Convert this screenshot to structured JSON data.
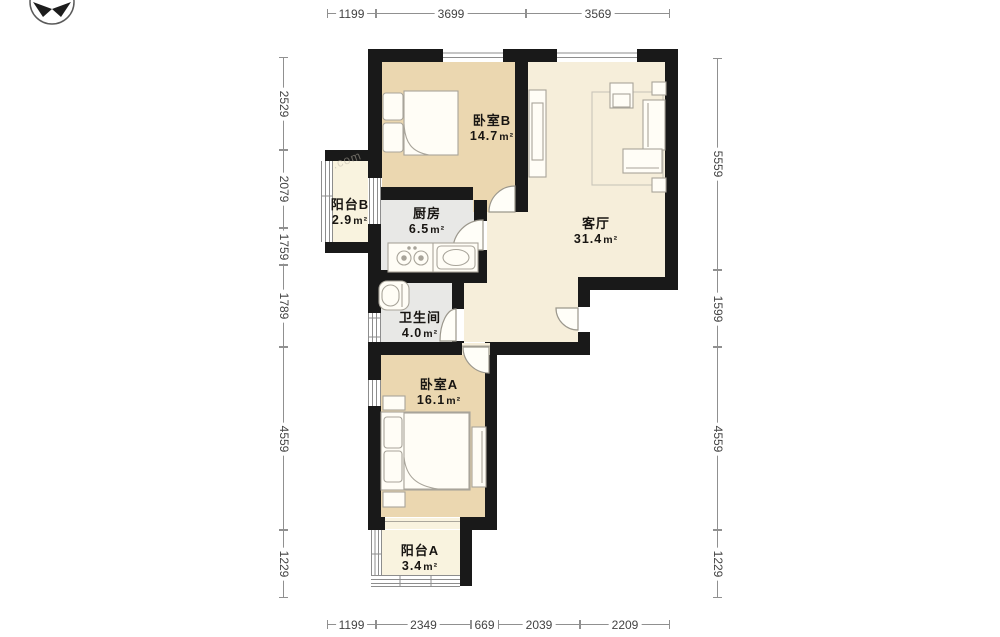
{
  "rooms": [
    {
      "name": "卧室B",
      "area": "14.7",
      "unit": "m²"
    },
    {
      "name": "客厅",
      "area": "31.4",
      "unit": "m²"
    },
    {
      "name": "厨房",
      "area": "6.5",
      "unit": "m²"
    },
    {
      "name": "阳台B",
      "area": "2.9",
      "unit": "m²"
    },
    {
      "name": "卫生间",
      "area": "4.0",
      "unit": "m²"
    },
    {
      "name": "卧室A",
      "area": "16.1",
      "unit": "m²"
    },
    {
      "name": "阳台A",
      "area": "3.4",
      "unit": "m²"
    }
  ],
  "dims": {
    "top": [
      "1199",
      "3699",
      "3569"
    ],
    "bottom": [
      "1199",
      "2349",
      "669",
      "2039",
      "2209"
    ],
    "left": [
      "2529",
      "2079",
      "1759",
      "1789",
      "4559",
      "1229"
    ],
    "right": [
      "5559",
      "1599",
      "4559",
      "1229"
    ]
  },
  "icons": {
    "compass": "north-compass-icon"
  },
  "watermark": {
    "text": ".com"
  }
}
